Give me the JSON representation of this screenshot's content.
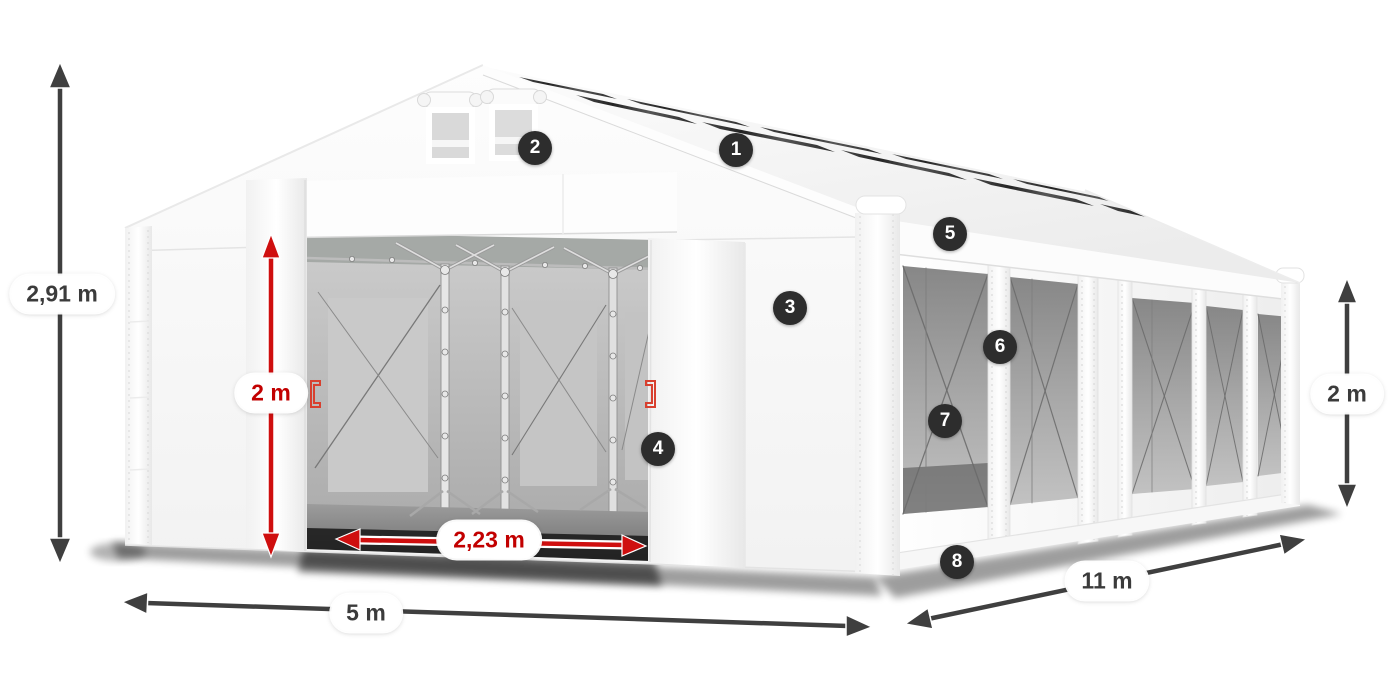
{
  "diagram": {
    "title": "tent-dimensions-diagram",
    "background": "#ffffff",
    "colors": {
      "dimension_arrow": "#3f3f3f",
      "dimension_text": "#3b3b3b",
      "door_dimension_arrow": "#cf0f0f",
      "door_dimension_text": "#c20000",
      "callout_background": "#2d2d2d",
      "callout_text": "#ffffff",
      "tent_white": "#ffffff",
      "skylight_dark": "#333333"
    },
    "dimensions": {
      "total_height": {
        "label": "2,91 m"
      },
      "front_width": {
        "label": "5 m"
      },
      "side_length": {
        "label": "11 m"
      },
      "wall_height": {
        "label": "2 m"
      },
      "door_height": {
        "label": "2 m"
      },
      "door_width": {
        "label": "2,23 m"
      }
    },
    "callouts": [
      {
        "number": "1"
      },
      {
        "number": "2"
      },
      {
        "number": "3"
      },
      {
        "number": "4"
      },
      {
        "number": "5"
      },
      {
        "number": "6"
      },
      {
        "number": "7"
      },
      {
        "number": "8"
      }
    ]
  }
}
